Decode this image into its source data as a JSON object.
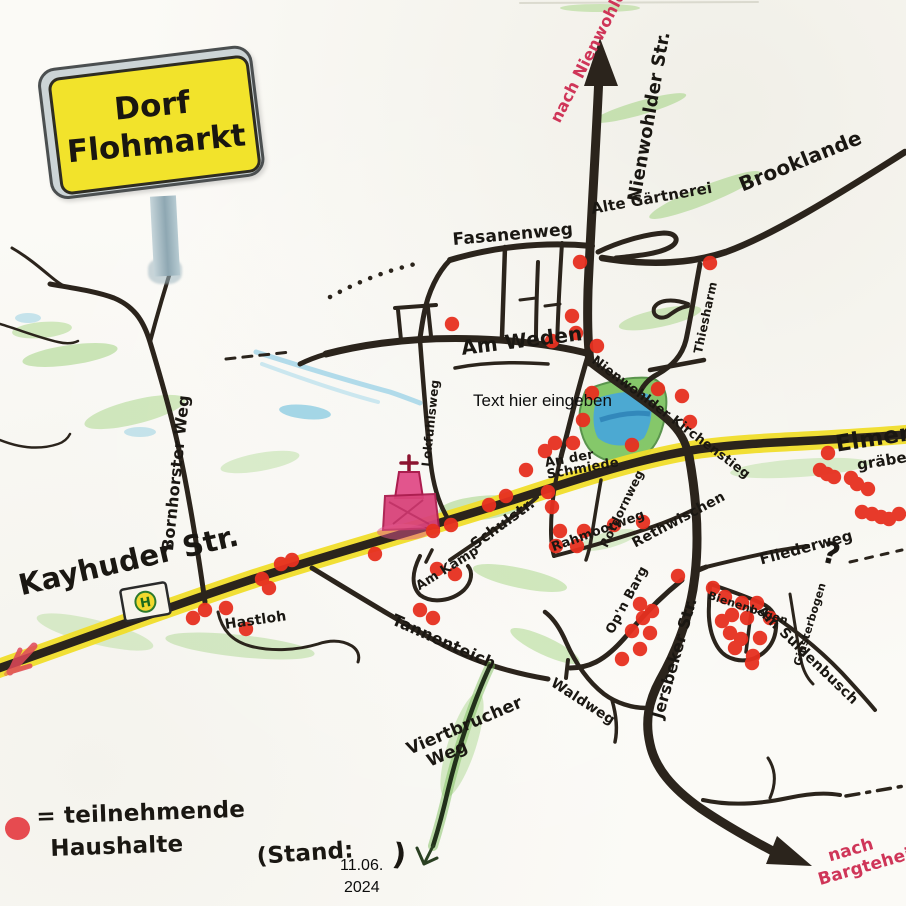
{
  "title_sign": {
    "line1": "Dorf",
    "line2": "Flohmarkt"
  },
  "directions": {
    "north": "nach Nienwohld",
    "southeast_line1": "nach",
    "southeast_line2": "Bargteheide"
  },
  "streets": {
    "nienwohlder_str": "Nienwohlder Str.",
    "fasanenweg": "Fasanenweg",
    "alte_gaertnerei": "Alte Gärtnerei",
    "brooklande": "Brooklande",
    "thiesharm": "Thiesharm",
    "am_weden": "Am Weden",
    "nienwohlder_kirchenstieg": "Nienwohlder Kirchenstieg",
    "bornhorster_weg": "Bornhorster Weg",
    "kayhuder_str": "Kayhuder Str.",
    "elmenhorst_line1": "Elmenhorst",
    "elmenhorst_line2": "gräben",
    "schulstr": "Schulstr.",
    "am_kamp": "Am Kamp",
    "lokfuhlsweg": "Lokfuhlsweg",
    "an_der_schmiede_line1": "An der",
    "an_der_schmiede_line2": "Schmiede",
    "rahmoorweg": "Rahmoorweg",
    "rotdornweg": "Rotdornweg",
    "rethwischen": "Rethwischen",
    "opn_barg": "Op'n Barg",
    "jersbeker_str": "Jersbeker Str.",
    "fliederweg": "Fliederweg",
    "bienenbogen": "Bienenbogen",
    "ginsterbogen": "Ginsterbogen",
    "am_suldenbusch": "Am Suldenbusch",
    "tannenteich": "Tannenteich",
    "waldweg": "Waldweg",
    "viertbrucher_line1": "Viertbrucher",
    "viertbrucher_line2": "Weg",
    "hastloh": "Hastloh"
  },
  "overlay_artifact": {
    "text": "Text hier eingeben"
  },
  "legend": {
    "line1": "= teilnehmende",
    "line2": "Haushalte",
    "stand_prefix": "(Stand:",
    "stand_date": "11.06.",
    "stand_year": "2024",
    "stand_suffix": ")"
  },
  "bus_stop": {
    "glyph": "H"
  },
  "question_mark": "?",
  "map": {
    "colors": {
      "dot": "#e73020",
      "road": "#2b241c",
      "main_road_casing": "#f0dd2a",
      "direction_text": "#cf3558",
      "sign_yellow": "#f2e32b",
      "pond_blue": "#49a8d8",
      "vegetation_green": "#90cc6a",
      "church_pink": "#d9437a"
    },
    "participant_dots": [
      [
        580,
        262
      ],
      [
        710,
        263
      ],
      [
        452,
        324
      ],
      [
        572,
        316
      ],
      [
        576,
        333
      ],
      [
        552,
        341
      ],
      [
        597,
        346
      ],
      [
        592,
        393
      ],
      [
        583,
        420
      ],
      [
        658,
        389
      ],
      [
        682,
        396
      ],
      [
        690,
        422
      ],
      [
        555,
        443
      ],
      [
        573,
        443
      ],
      [
        545,
        451
      ],
      [
        632,
        445
      ],
      [
        548,
        492
      ],
      [
        552,
        507
      ],
      [
        560,
        531
      ],
      [
        584,
        531
      ],
      [
        556,
        546
      ],
      [
        577,
        546
      ],
      [
        614,
        525
      ],
      [
        643,
        522
      ],
      [
        526,
        470
      ],
      [
        506,
        496
      ],
      [
        489,
        505
      ],
      [
        451,
        525
      ],
      [
        433,
        531
      ],
      [
        375,
        554
      ],
      [
        292,
        560
      ],
      [
        281,
        564
      ],
      [
        262,
        579
      ],
      [
        269,
        588
      ],
      [
        226,
        608
      ],
      [
        205,
        610
      ],
      [
        193,
        618
      ],
      [
        246,
        629
      ],
      [
        420,
        610
      ],
      [
        433,
        618
      ],
      [
        437,
        569
      ],
      [
        455,
        574
      ],
      [
        828,
        453
      ],
      [
        820,
        470
      ],
      [
        827,
        474
      ],
      [
        834,
        477
      ],
      [
        851,
        478
      ],
      [
        857,
        484
      ],
      [
        868,
        489
      ],
      [
        862,
        512
      ],
      [
        872,
        514
      ],
      [
        881,
        517
      ],
      [
        889,
        519
      ],
      [
        899,
        514
      ],
      [
        678,
        576
      ],
      [
        640,
        604
      ],
      [
        652,
        611
      ],
      [
        643,
        618
      ],
      [
        632,
        631
      ],
      [
        650,
        633
      ],
      [
        640,
        649
      ],
      [
        622,
        659
      ],
      [
        713,
        588
      ],
      [
        725,
        597
      ],
      [
        742,
        603
      ],
      [
        757,
        603
      ],
      [
        732,
        615
      ],
      [
        747,
        618
      ],
      [
        770,
        618
      ],
      [
        722,
        621
      ],
      [
        730,
        633
      ],
      [
        741,
        639
      ],
      [
        760,
        638
      ],
      [
        735,
        648
      ],
      [
        753,
        656
      ],
      [
        752,
        663
      ]
    ]
  }
}
